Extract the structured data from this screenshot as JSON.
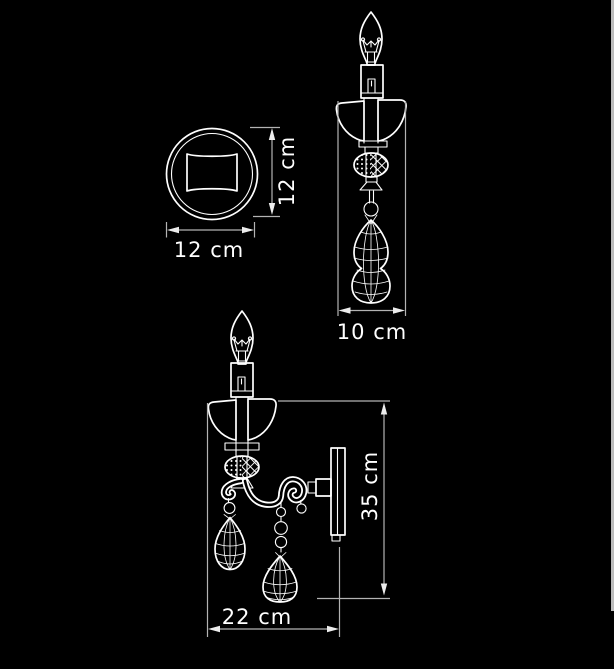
{
  "window": {
    "background_color": "#000000",
    "scrollbar_color": "#bdbdbd"
  },
  "diagram": {
    "line_color": "#ffffff",
    "dimension_line_color": "#b3b3b3",
    "label_color": "#ffffff",
    "views": {
      "backplate_front": {
        "width": {
          "label": "12 cm",
          "value": 12,
          "unit": "cm"
        },
        "height": {
          "label": "12 cm",
          "value": 12,
          "unit": "cm"
        }
      },
      "side": {
        "depth": {
          "label": "10 cm",
          "value": 10,
          "unit": "cm"
        }
      },
      "front": {
        "height": {
          "label": "35 cm",
          "value": 35,
          "unit": "cm"
        },
        "width": {
          "label": "22 cm",
          "value": 22,
          "unit": "cm"
        }
      }
    }
  }
}
